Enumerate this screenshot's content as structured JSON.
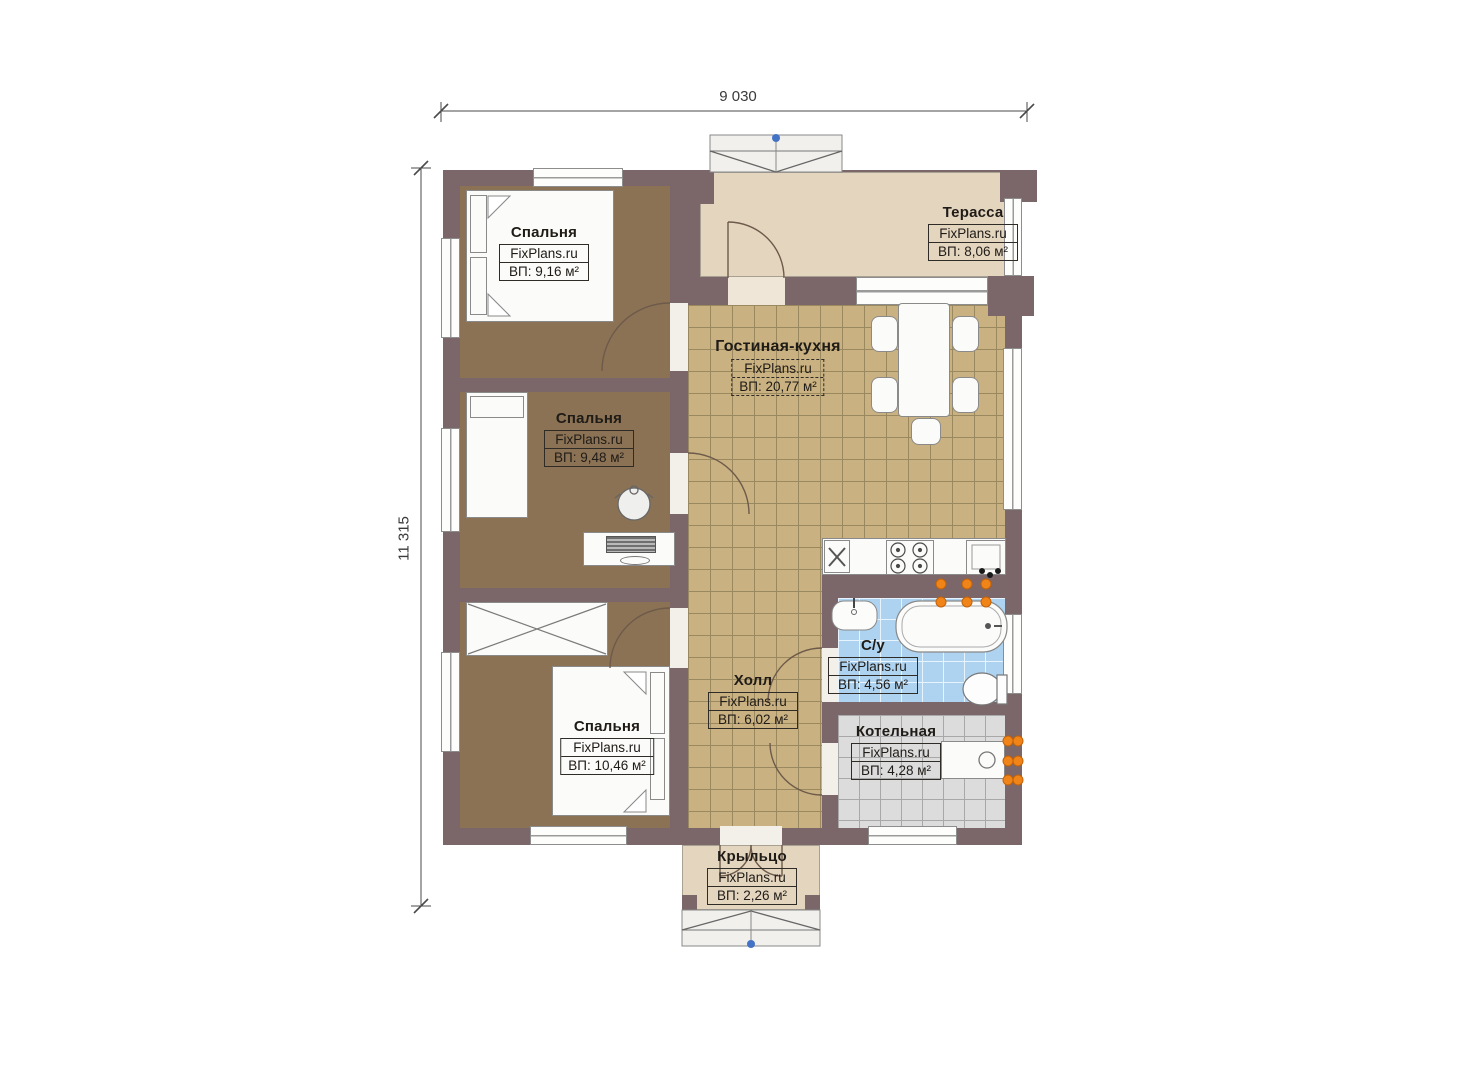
{
  "brand": "FixPlans.ru",
  "dimensions": {
    "width": "9 030",
    "height": "11 315"
  },
  "rooms": {
    "terrace": {
      "name": "Терасса",
      "area": "ВП: 8,06 м²"
    },
    "bedroom1": {
      "name": "Спальня",
      "area": "ВП: 9,16 м²"
    },
    "living_kitchen": {
      "name": "Гостиная-кухня",
      "area": "ВП: 20,77 м²"
    },
    "bedroom2": {
      "name": "Спальня",
      "area": "ВП: 9,48 м²"
    },
    "bedroom3": {
      "name": "Спальня",
      "area": "ВП: 10,46 м²"
    },
    "hall": {
      "name": "Холл",
      "area": "ВП: 6,02 м²"
    },
    "bathroom": {
      "name": "С/у",
      "area": "ВП: 4,56 м²"
    },
    "boiler_room": {
      "name": "Котельная",
      "area": "ВП: 4,28 м²"
    },
    "porch": {
      "name": "Крыльцо",
      "area": "ВП: 2,26 м²"
    }
  },
  "colors": {
    "wall": "#7b6669",
    "bedroom_floor": "#8b7254",
    "tile_floor": "#c9b181",
    "terrace_floor": "#e4d5bf",
    "bathroom_tile": "#aed3f0",
    "boiler_tile": "#dcdcdc",
    "radiator": "#f08418",
    "marker_dot": "#4472c4"
  }
}
